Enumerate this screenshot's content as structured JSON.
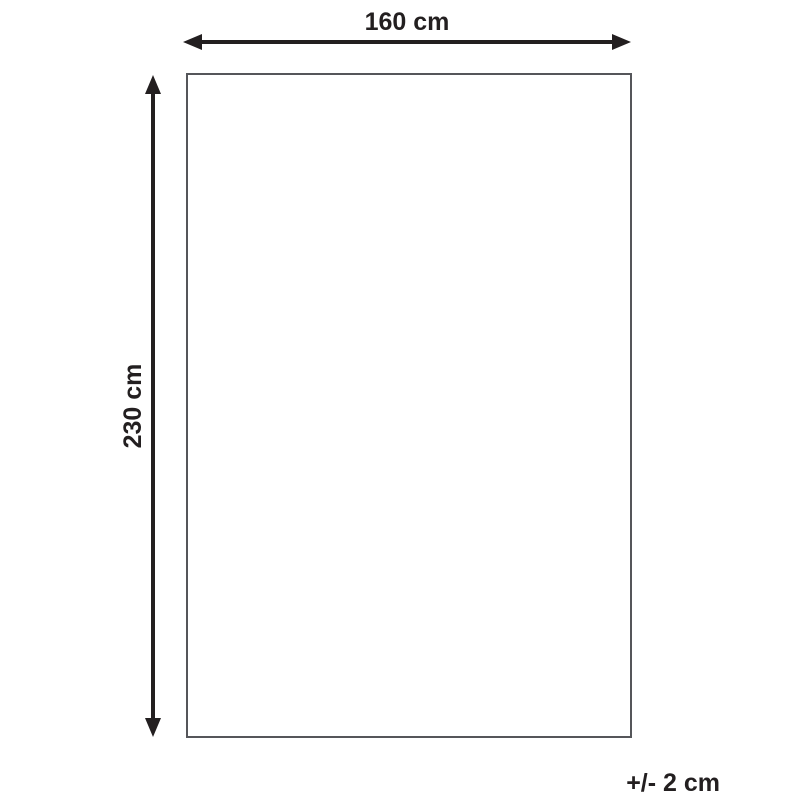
{
  "diagram": {
    "type": "product-dimension-diagram",
    "width_label": "160 cm",
    "height_label": "230 cm",
    "tolerance_label": "+/- 2 cm",
    "colors": {
      "background": "#ffffff",
      "arrow": "#231f20",
      "text": "#231f20",
      "rect_border": "#55565a",
      "rect_fill": "#ffffff"
    }
  }
}
